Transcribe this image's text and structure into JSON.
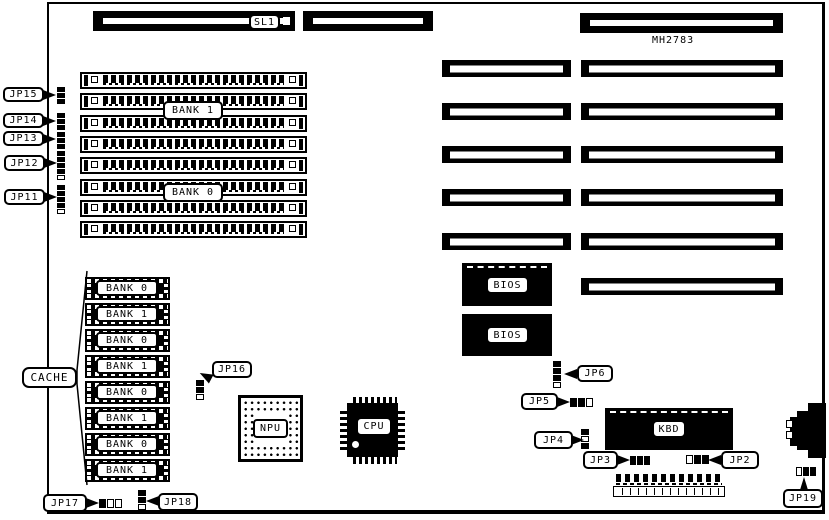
{
  "colors": {
    "ink": "#000000",
    "paper": "#ffffff"
  },
  "board": {
    "part_number": "MH2783"
  },
  "top_slots": {
    "sl1_label": "SL1"
  },
  "memory": {
    "bank1_label": "BANK 1",
    "bank0_label": "BANK 0"
  },
  "cache": {
    "label": "CACHE",
    "chips": [
      "BANK 0",
      "BANK 1",
      "BANK 0",
      "BANK 1",
      "BANK 0",
      "BANK 1",
      "BANK 0",
      "BANK 1"
    ]
  },
  "components": {
    "bios_top": "BIOS",
    "bios_bottom": "BIOS",
    "keyboard_controller": "KBD",
    "npu": "NPU",
    "cpu": "CPU"
  },
  "jumpers": {
    "jp2": "JP2",
    "jp3": "JP3",
    "jp4": "JP4",
    "jp5": "JP5",
    "jp6": "JP6",
    "jp11": "JP11",
    "jp12": "JP12",
    "jp13": "JP13",
    "jp14": "JP14",
    "jp15": "JP15",
    "jp16": "JP16",
    "jp17": "JP17",
    "jp18": "JP18",
    "jp19": "JP19"
  }
}
